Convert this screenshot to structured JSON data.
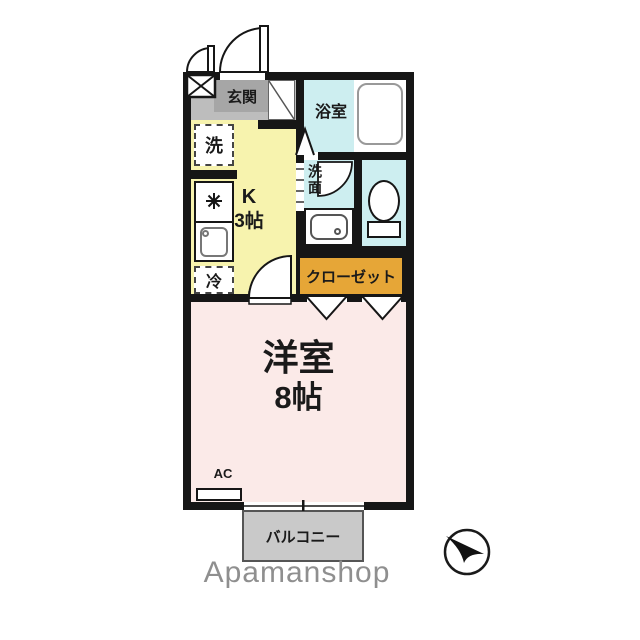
{
  "plan": {
    "entrance": {
      "label": "玄関"
    },
    "bathroom": {
      "label": "浴室"
    },
    "laundry": {
      "label": "洗"
    },
    "kitchen": {
      "label_line1": "K",
      "label_line2": "3帖"
    },
    "washroom": {
      "label": "洗面"
    },
    "fridge": {
      "label": "冷"
    },
    "closet": {
      "label": "クローゼット"
    },
    "room": {
      "label_line1": "洋室",
      "label_line2": "8帖"
    },
    "ac": {
      "label": "AC"
    },
    "balcony": {
      "label": "バルコニー"
    }
  },
  "watermark": {
    "text": "Apamanshop"
  },
  "colors": {
    "wall": "#161616",
    "kitchen": "#f7f3ae",
    "wet_rooms": "#cdeef0",
    "closet": "#e6a637",
    "room": "#fbeae8",
    "entrance": "#bdbdbd",
    "balcony": "#c9c9c9",
    "watermark": "#8f8f8f"
  }
}
